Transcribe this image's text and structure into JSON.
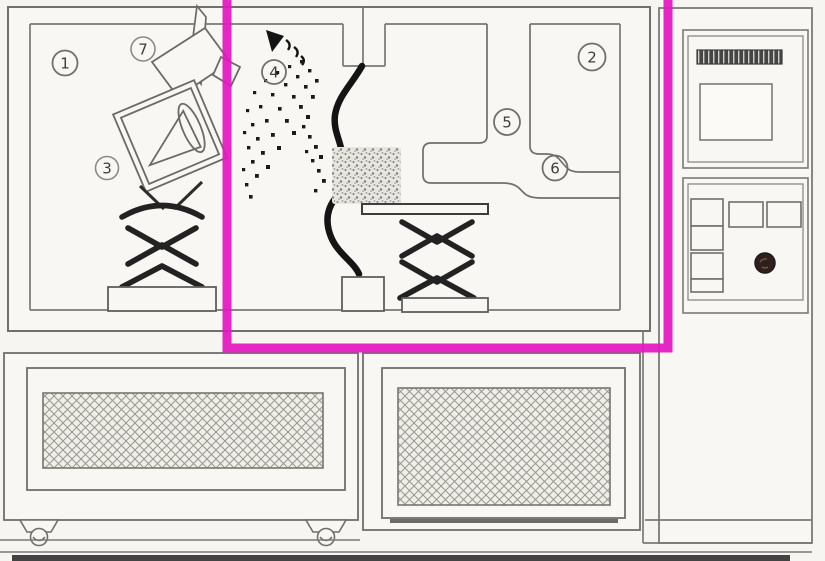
{
  "diagram": {
    "type": "scanned-technical-schematic",
    "highlight_color": "#e318c1",
    "line_color": "#6f6f6f",
    "dark_color": "#161616",
    "paper_color": "#f6f5f1",
    "labels": [
      {
        "number": "1",
        "x": 65,
        "y": 63
      },
      {
        "number": "2",
        "x": 592,
        "y": 57
      },
      {
        "number": "3",
        "x": 107,
        "y": 168
      },
      {
        "number": "4",
        "x": 274,
        "y": 72
      },
      {
        "number": "5",
        "x": 507,
        "y": 122
      },
      {
        "number": "6",
        "x": 555,
        "y": 168
      },
      {
        "number": "7",
        "x": 143,
        "y": 49
      }
    ]
  }
}
